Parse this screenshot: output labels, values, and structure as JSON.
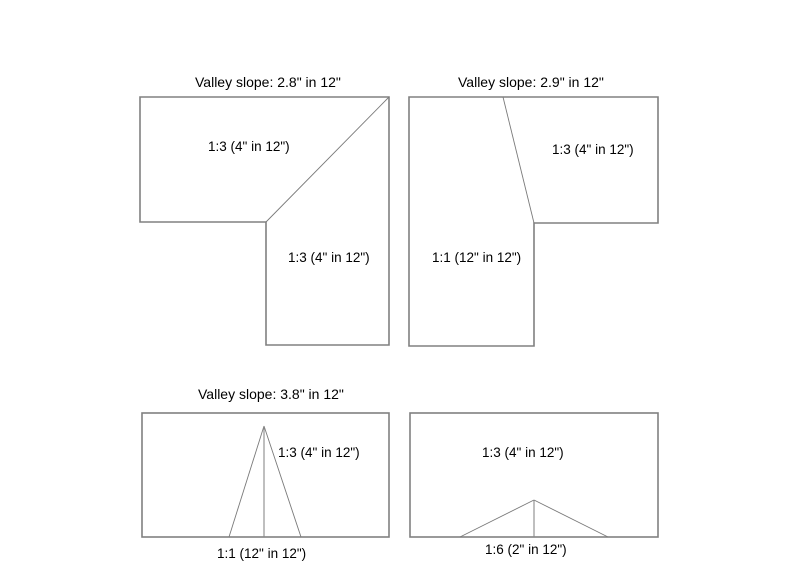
{
  "page": {
    "background_color": "#ffffff",
    "outline_color": "#808080",
    "text_color": "#000000"
  },
  "diagrams": [
    {
      "id": "top-left-valley",
      "shape": "L-shaped roof plan with diagonal valley line",
      "title": "Valley slope: 2.8\" in 12\"",
      "labels": [
        "1:3 (4\" in 12\")",
        "1:3 (4\" in 12\")"
      ]
    },
    {
      "id": "top-right-valley",
      "shape": "mirrored L-shaped roof plan with valley line",
      "title": "Valley slope: 2.9\" in 12\"",
      "labels": [
        "1:3 (4\" in 12\")",
        "1:1 (12\" in 12\")"
      ]
    },
    {
      "id": "bottom-left-valley",
      "shape": "rectangular roof plan with steep gable triangle",
      "title": "Valley slope: 3.8\" in 12\"",
      "labels": [
        "1:3 (4\" in 12\")",
        "1:1 (12\" in 12\")"
      ]
    },
    {
      "id": "bottom-right-valley",
      "shape": "rectangular roof plan with shallow gable triangle",
      "title": "",
      "labels": [
        "1:3 (4\" in 12\")",
        "1:6 (2\" in 12\")"
      ]
    }
  ]
}
